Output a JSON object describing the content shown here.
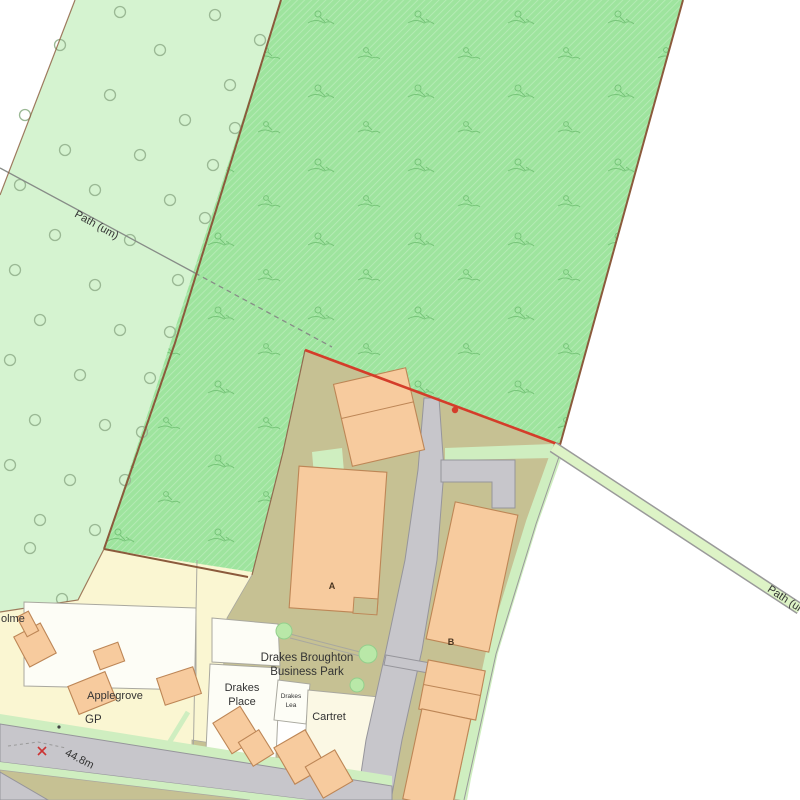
{
  "map": {
    "title": "Drakes Broughton Business Park site plan",
    "labels": {
      "path_um_left": "Path (um)",
      "path_um_right": "Path (um)",
      "holme": "olme",
      "applegrove": "Applegrove",
      "gp": "GP",
      "spot_height": "44.8m",
      "business_park_line1": "Drakes Broughton",
      "business_park_line2": "Business Park",
      "drakes_place_line1": "Drakes",
      "drakes_place_line2": "Place",
      "drakes_lea_line1": "Drakes",
      "drakes_lea_line2": "Lea",
      "cartret": "Cartret",
      "building_a": "A",
      "building_b": "B"
    },
    "colors": {
      "field_light": "#d5f3d0",
      "field_dark": "#9ee49e",
      "scrub_symbol": "#6fbf72",
      "tree_edge": "#9ab894",
      "cream": "#faf6d2",
      "olive": "#c6c193",
      "road": "#c7c6cb",
      "road_edge": "#96959b",
      "verge": "#cfeec0",
      "path_green": "#ddf3c6",
      "white_plot": "#fdfdf6",
      "building": "#f7cb9e",
      "building_edge": "#bd8656",
      "boundary_brown": "#8b5a3c",
      "boundary_red": "#d43d2a",
      "bush": "#b9e8a8",
      "plot_line": "#a9a89f",
      "label": "#333333"
    }
  }
}
